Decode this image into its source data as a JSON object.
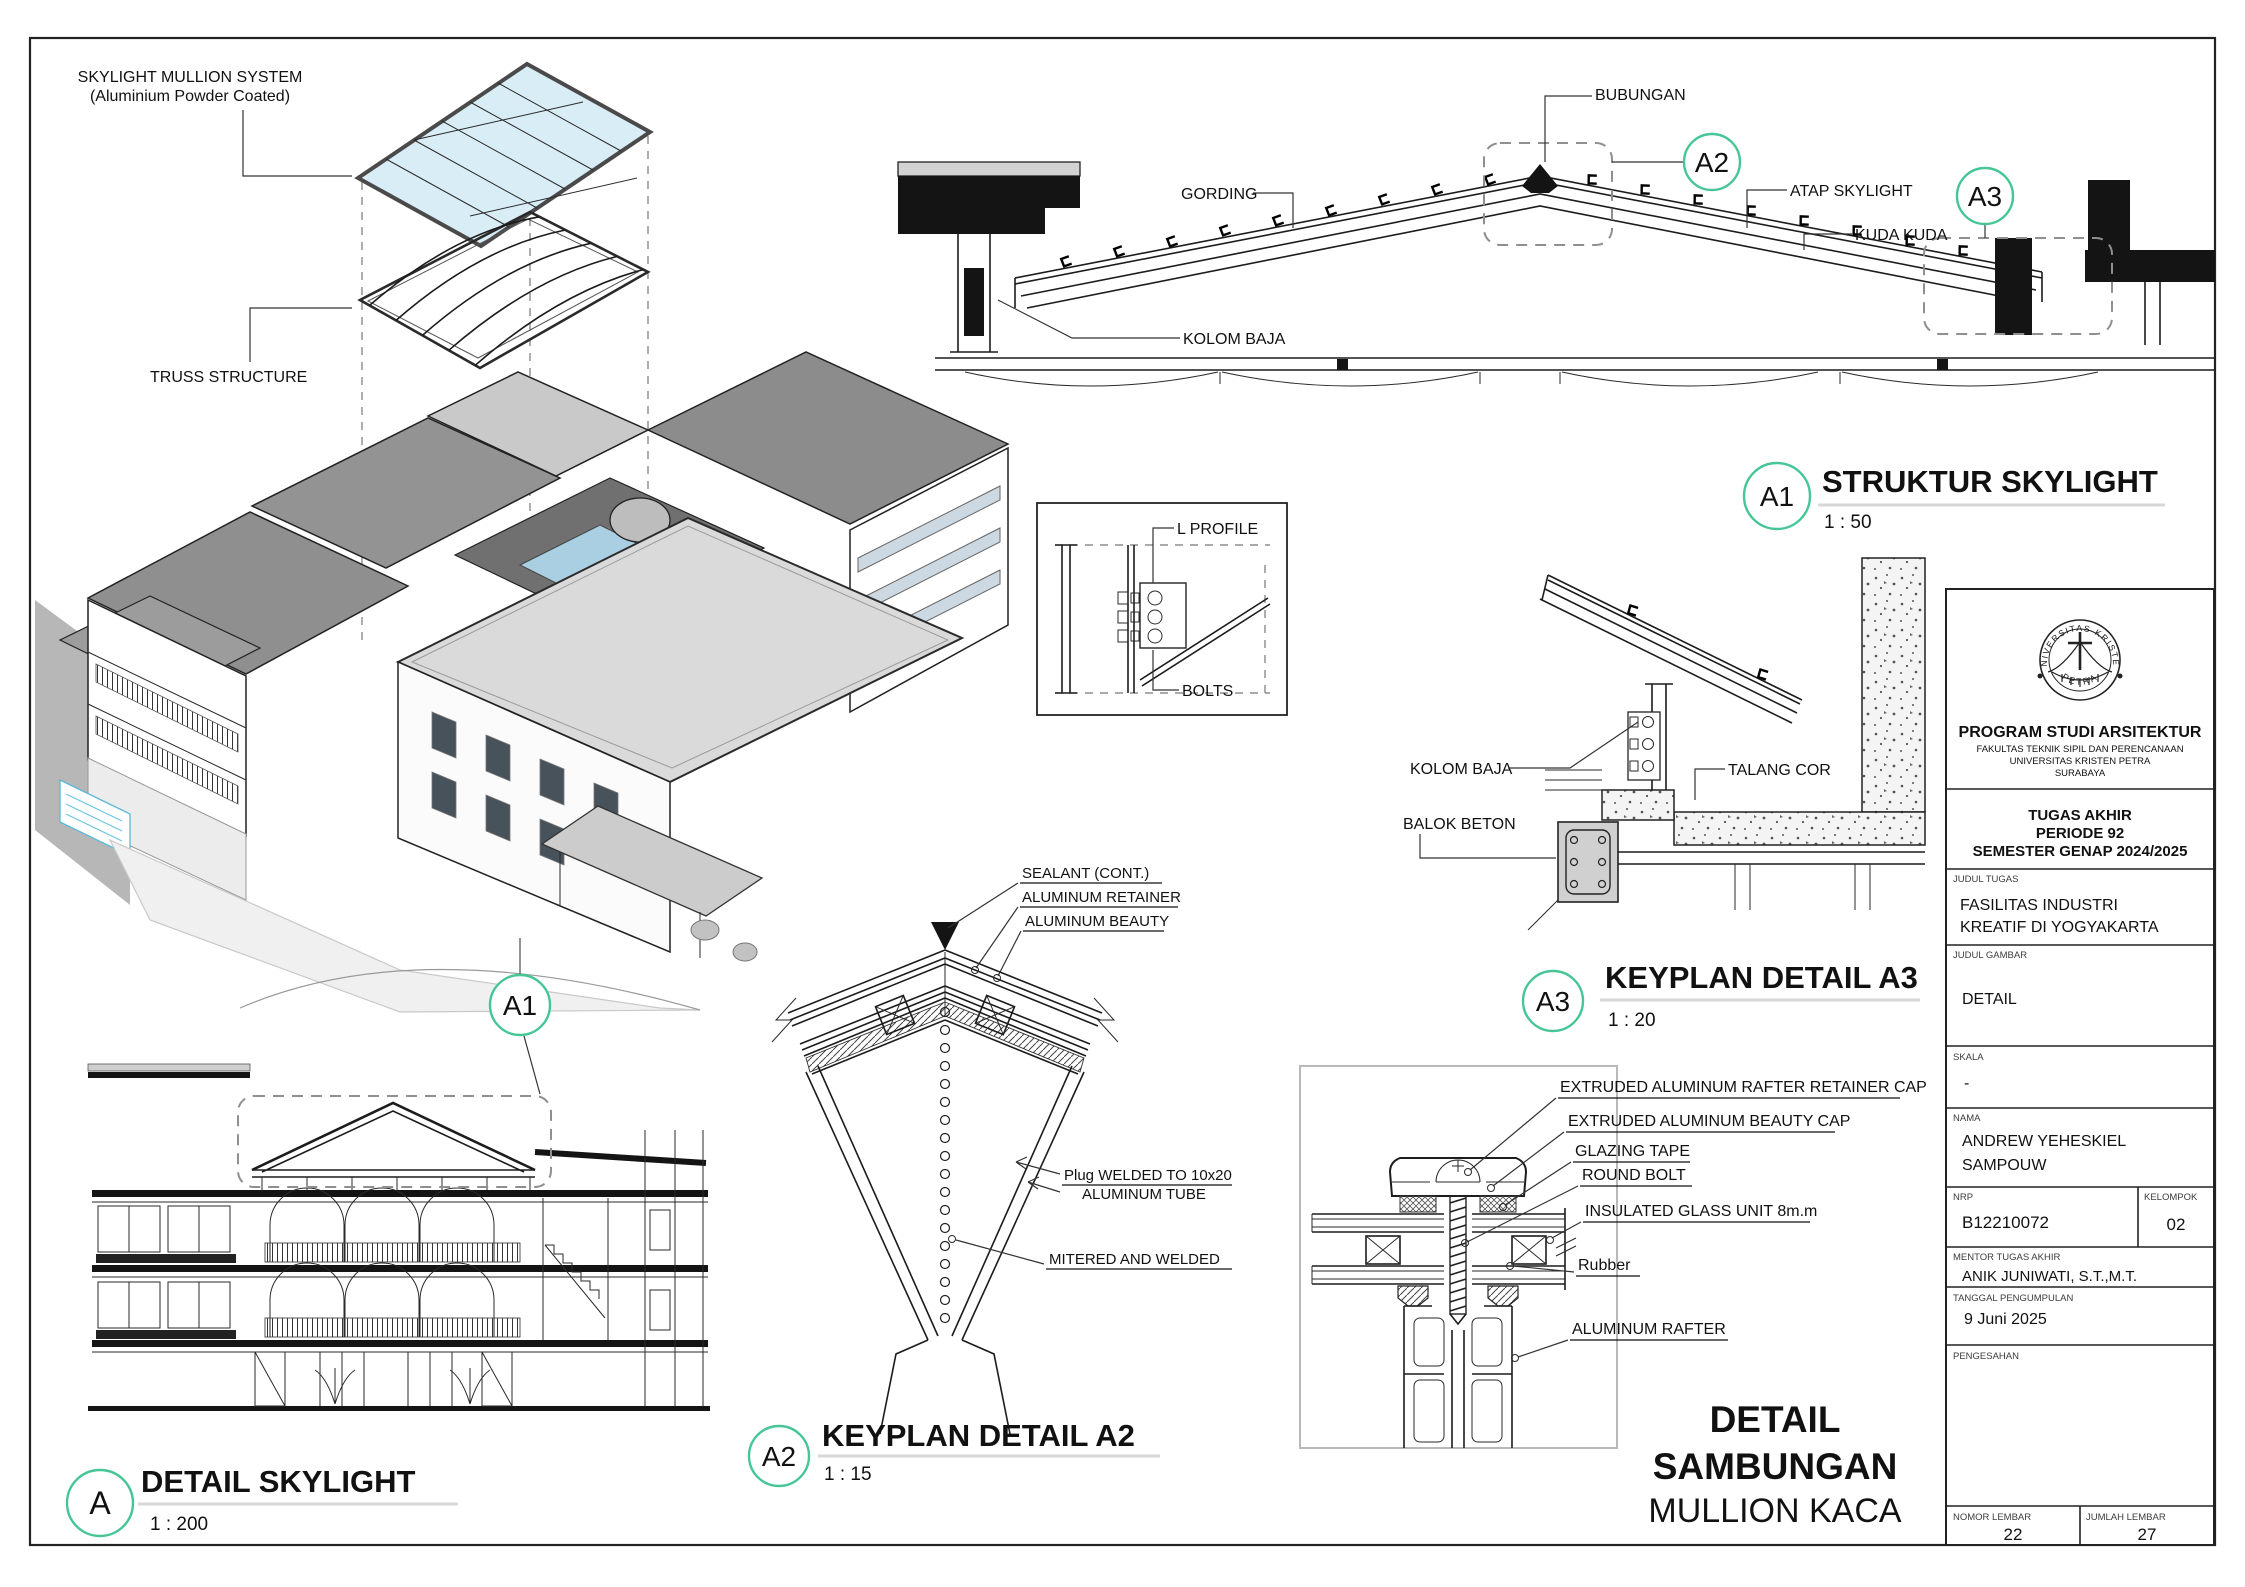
{
  "accent": "#45c694",
  "line_color": "#1c1c1c",
  "glass_color": "#d9edf7",
  "axon": {
    "skylight_label_1": "SKYLIGHT MULLION SYSTEM",
    "skylight_label_2": "(Aluminium Powder Coated)",
    "truss_label": "TRUSS STRUCTURE",
    "marker": "A1"
  },
  "struktur": {
    "marker": "A1",
    "title": "STRUKTUR SKYLIGHT",
    "scale": "1 : 50",
    "bubungan": "BUBUNGAN",
    "gording": "GORDING",
    "atap": "ATAP SKYLIGHT",
    "kuda": "KUDA KUDA",
    "kolom": "KOLOM BAJA",
    "a2": "A2",
    "a3": "A3"
  },
  "lprofile": {
    "top": "L PROFILE",
    "bottom": "BOLTS"
  },
  "keyplan_a3": {
    "marker": "A3",
    "title": "KEYPLAN DETAIL A3",
    "scale": "1 : 20",
    "kolom": "KOLOM BAJA",
    "talang": "TALANG  COR",
    "balok": "BALOK BETON"
  },
  "detail_skylight": {
    "marker": "A",
    "title": "DETAIL SKYLIGHT",
    "scale": "1 : 200"
  },
  "keyplan_a2": {
    "marker": "A2",
    "title": "KEYPLAN DETAIL A2",
    "scale": "1 : 15",
    "sealant": "SEALANT (CONT.)",
    "retainer": "ALUMINUM RETAINER",
    "beauty": "ALUMINUM BEAUTY",
    "plug_1": "Plug WELDED TO 10x20",
    "plug_2": "ALUMINUM  TUBE",
    "mitered": "MITERED AND WELDED"
  },
  "mullion": {
    "retainer_cap": "EXTRUDED ALUMINUM  RAFTER RETAINER CAP",
    "beauty_cap": "EXTRUDED ALUMINUM  BEAUTY CAP",
    "glazing_tape": "GLAZING TAPE",
    "round_bolt": "ROUND BOLT",
    "glass": "INSULATED GLASS UNIT 8m.m",
    "rubber": "Rubber",
    "rafter": "ALUMINUM RAFTER",
    "title_1": "DETAIL",
    "title_2": "SAMBUNGAN",
    "title_3": "MULLION KACA"
  },
  "titleblock": {
    "logo_arc": "UNIVERSITAS KRISTEN",
    "logo_petra": "PETRA",
    "program": "PROGRAM STUDI ARSITEKTUR",
    "fakultas": "FAKULTAS TEKNIK SIPIL DAN PERENCANAAN",
    "universitas": "UNIVERSITAS KRISTEN PETRA",
    "kota": "SURABAYA",
    "tugas": "TUGAS AKHIR",
    "periode": "PERIODE 92",
    "semester": "SEMESTER GENAP 2024/2025",
    "judul_tugas_label": "JUDUL TUGAS",
    "judul_tugas_1": "FASILITAS INDUSTRI",
    "judul_tugas_2": "KREATIF DI YOGYAKARTA",
    "judul_gambar_label": "JUDUL GAMBAR",
    "judul_gambar": "DETAIL",
    "skala_label": "SKALA",
    "skala": "-",
    "nama_label": "NAMA",
    "nama_1": "ANDREW YEHESKIEL",
    "nama_2": "SAMPOUW",
    "nrp_label": "NRP",
    "nrp": "B12210072",
    "kelompok_label": "KELOMPOK",
    "kelompok": "02",
    "mentor_label": "MENTOR TUGAS AKHIR",
    "mentor": "ANIK JUNIWATI, S.T.,M.T.",
    "tanggal_label": "TANGGAL PENGUMPULAN",
    "tanggal": "9 Juni 2025",
    "pengesahan_label": "PENGESAHAN",
    "nomor_label": "NOMOR LEMBAR",
    "nomor": "22",
    "jumlah_label": "JUMLAH LEMBAR",
    "jumlah": "27"
  }
}
